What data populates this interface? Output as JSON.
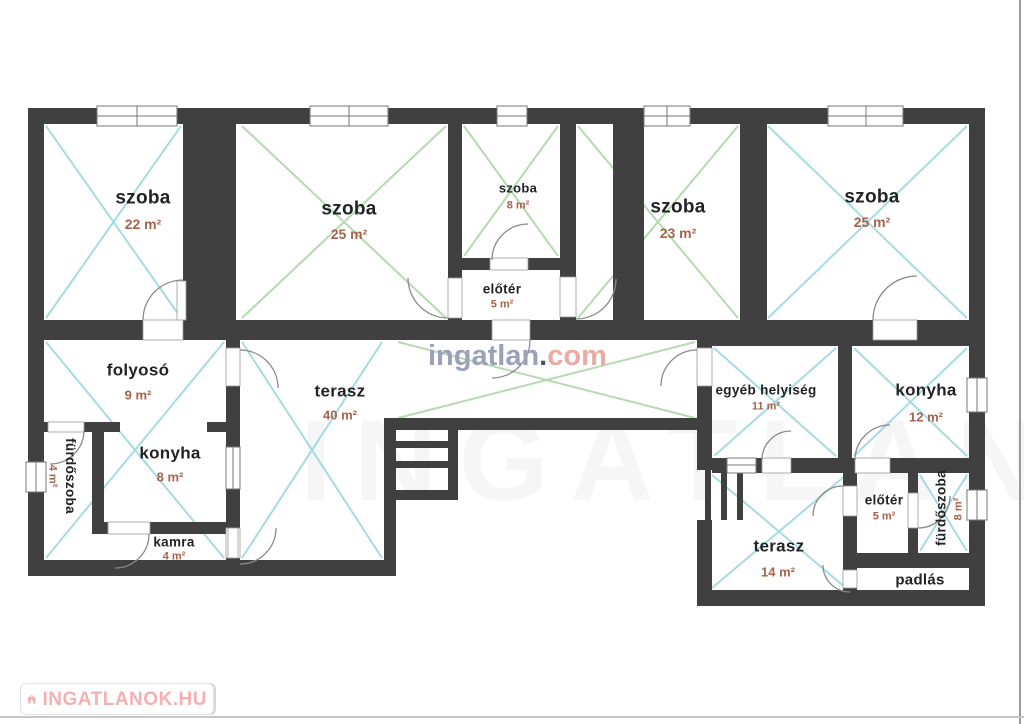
{
  "watermark": {
    "name": "ingatlan",
    "dot": ".",
    "tld": "com"
  },
  "ghost_watermark": "INGATLAN",
  "footer": {
    "brand": "INGATLANOK.HU"
  },
  "colors": {
    "wall": "#404040",
    "cyan_diagonal": "#8fd4da",
    "green_diagonal": "#a3d19c",
    "room_name_text": "#222326",
    "area_text": "#a5634c",
    "watermark_gray": "#9ba1b8",
    "watermark_pink": "#e9aba2",
    "brand_pink": "#f4b0b0"
  },
  "rooms": [
    {
      "name": "szoba",
      "area": "22 m²"
    },
    {
      "name": "szoba",
      "area": "25 m²"
    },
    {
      "name": "szoba",
      "area": "8 m²"
    },
    {
      "name": "előtér",
      "area": "5 m²"
    },
    {
      "name": "szoba",
      "area": "23 m²"
    },
    {
      "name": "szoba",
      "area": "25 m²"
    },
    {
      "name": "folyosó",
      "area": "9 m²"
    },
    {
      "name": "fürdőszoba",
      "area": "4 m²"
    },
    {
      "name": "konyha",
      "area": "8 m²"
    },
    {
      "name": "kamra",
      "area": "4 m²"
    },
    {
      "name": "terasz",
      "area": "40 m²"
    },
    {
      "name": "egyéb helyiség",
      "area": "11 m²"
    },
    {
      "name": "konyha",
      "area": "12 m²"
    },
    {
      "name": "előtér",
      "area": "5 m²"
    },
    {
      "name": "fürdőszoba",
      "area": "8 m²"
    },
    {
      "name": "terasz",
      "area": "14 m²"
    },
    {
      "name": "padlás",
      "area": ""
    }
  ]
}
